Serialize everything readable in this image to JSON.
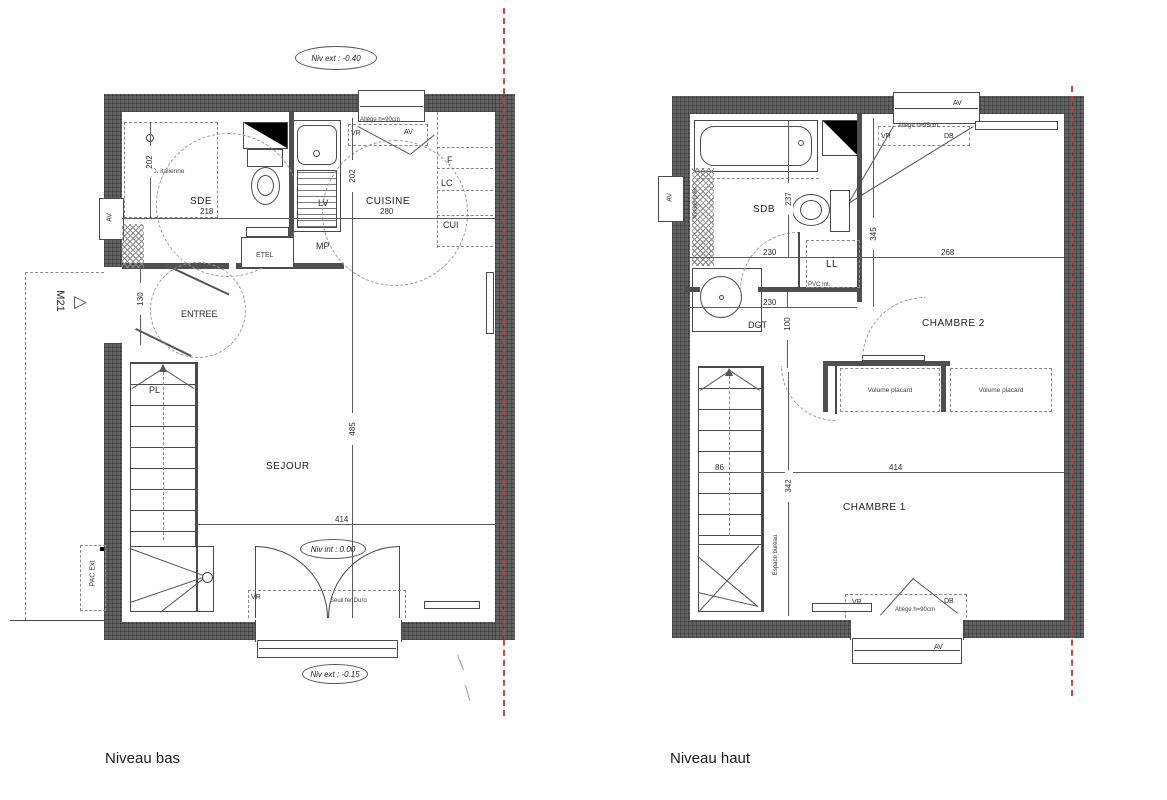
{
  "captions": {
    "niveau_bas": "Niveau bas",
    "niveau_haut": "Niveau haut"
  },
  "colors": {
    "wall": "#616161",
    "line": "#4a4a4a",
    "red_axis": "#cf3333"
  },
  "niveau_bas": {
    "levels": {
      "ext_top": "Niv ext : -0.40",
      "int": "Niv int : 0.00",
      "ext_bottom": "Niv ext : -0.15"
    },
    "rooms": {
      "sde": "SDE",
      "cuisine": "CUISINE",
      "entree": "ENTREE",
      "pl": "PL",
      "sejour": "SEJOUR"
    },
    "dims": {
      "sde_w": "218",
      "cuisine_w": "280",
      "cuisine_d": "202",
      "sde_d": "202",
      "entree_w": "130",
      "sejour_d": "485",
      "sejour_w": "414"
    },
    "ann": {
      "m21": "M21",
      "m21_marker": "▷",
      "pac": "PAC Ext",
      "d_italienne": "D. italienne",
      "etel": "ETEL",
      "lv": "LV",
      "mp": "MP",
      "f": "F",
      "lc": "LC",
      "cui": "CUI",
      "av": "AV",
      "vr": "VR",
      "allege90": "Allège h=90cm",
      "seuil": "Seuil fer Duro"
    }
  },
  "niveau_haut": {
    "rooms": {
      "sdb": "SDB",
      "dgt": "DGT",
      "chambre2": "CHAMBRE 2",
      "chambre1": "CHAMBRE 1"
    },
    "dims": {
      "sdb_d": "237",
      "sdb_w": "230",
      "dgt_w": "230",
      "dgt_d": "100",
      "ch2_d": "345",
      "ch2_w": "268",
      "stair_w": "86",
      "ch1_d": "342",
      "ch1_w": "414"
    },
    "ann": {
      "ll": "LL",
      "pvc": "PVC Int.",
      "placard": "Volume placard",
      "bureau": "Espace bureau",
      "av": "AV",
      "vr": "VR",
      "db": "DB",
      "allege95": "Allège h=95cm",
      "allege90": "Allège h=90cm",
      "vidage": "Vidage grille"
    }
  }
}
